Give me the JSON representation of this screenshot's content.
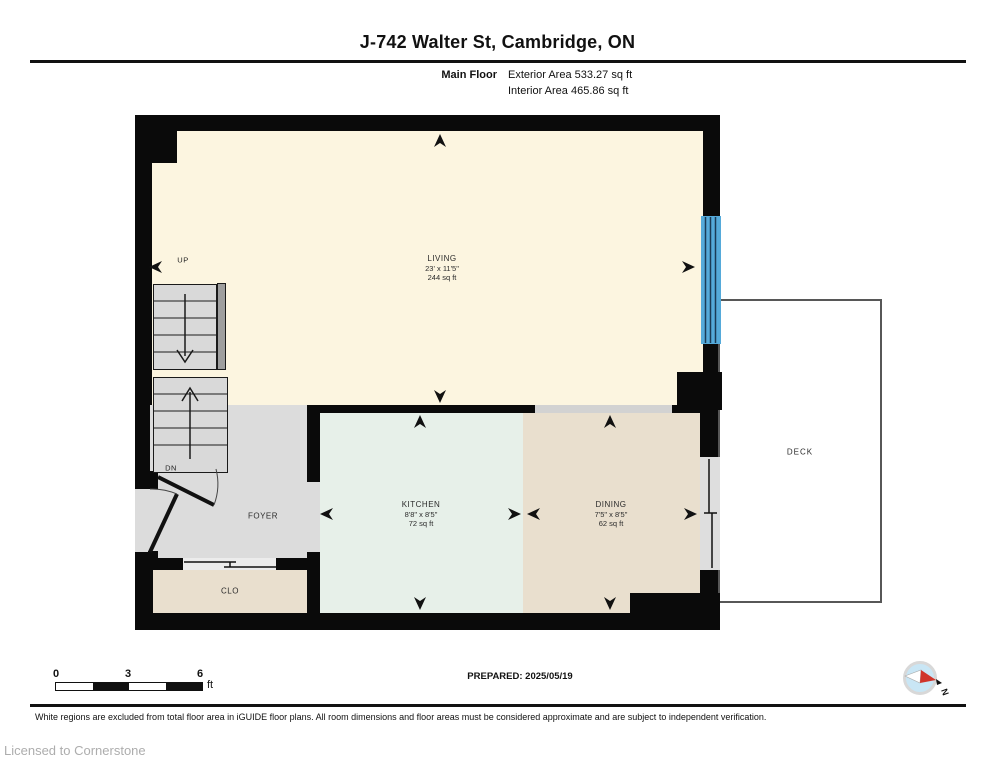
{
  "header": {
    "title": "J-742 Walter St, Cambridge, ON",
    "floor_label": "Main Floor",
    "exterior_area": "Exterior Area 533.27 sq ft",
    "interior_area": "Interior Area 465.86 sq ft"
  },
  "rooms": {
    "living": {
      "name": "LIVING",
      "dims": "23' x 11'5\"",
      "area": "244 sq ft"
    },
    "kitchen": {
      "name": "KITCHEN",
      "dims": "8'8\" x 8'5\"",
      "area": "72 sq ft"
    },
    "dining": {
      "name": "DINING",
      "dims": "7'5\" x 8'5\"",
      "area": "62 sq ft"
    },
    "foyer": {
      "name": "FOYER"
    },
    "closet": {
      "name": "CLO"
    },
    "deck": {
      "name": "DECK"
    }
  },
  "stairs": {
    "up_label": "UP",
    "down_label": "DN"
  },
  "scale_bar": {
    "ticks": [
      "0",
      "3",
      "6"
    ],
    "unit": "ft"
  },
  "footer": {
    "prepared": "PREPARED: 2025/05/19",
    "disclaimer": "White regions are excluded from total floor area in iGUIDE floor plans. All room dimensions and floor areas must be considered approximate and are subject to independent verification.",
    "license": "Licensed to Cornerstone"
  },
  "compass": {
    "label": "N"
  },
  "colors": {
    "wall": "#0A0A0A",
    "living": "#FCF5E0",
    "kitchen": "#E7F0E9",
    "dining": "#E9DFCE",
    "foyer": "#DCDCDC",
    "stairs": "#D9D9D9",
    "stair_rail": "#9E9E9E",
    "window": "#55AADA",
    "window_line": "#1B3B56",
    "deck_border": "#575757",
    "compass_red": "#D0342A",
    "compass_blue": "#C9E6F5"
  }
}
